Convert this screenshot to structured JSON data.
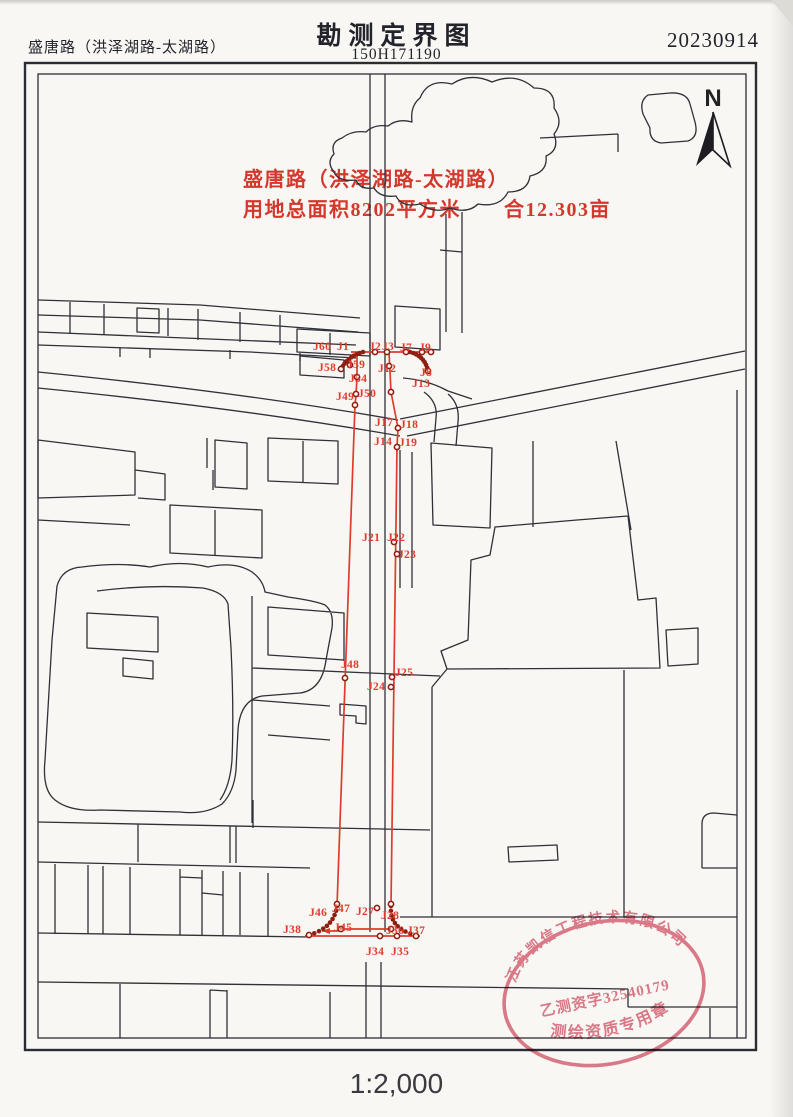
{
  "header": {
    "project": "盛唐路（洪泽湖路-太湖路）",
    "title": "勘测定界图",
    "sheet_no": "150H171190",
    "date": "20230914"
  },
  "annotation": {
    "line1": "盛唐路（洪泽湖路-太湖路）",
    "line2": "用地总面积8202平方米　　合12.303亩",
    "color": "#d4372b"
  },
  "north_label": "N",
  "scale_label": "1:2,000",
  "stamp": {
    "company": "江苏凯信工程技术有限公司",
    "license": "乙测资字32540179",
    "type_label": "测绘资质专用章",
    "color": "#d95f72"
  },
  "survey": {
    "line_color": "#e03c2d",
    "dot_color": "#8e1f12",
    "lines": [
      [
        [
          351,
          352
        ],
        [
          431,
          352
        ]
      ],
      [
        [
          357,
          352
        ],
        [
          357,
          377
        ],
        [
          356,
          395
        ],
        [
          355,
          405
        ],
        [
          337,
          906
        ]
      ],
      [
        [
          389,
          352
        ],
        [
          391,
          392
        ],
        [
          398,
          428
        ],
        [
          397,
          447
        ],
        [
          394,
          675
        ],
        [
          391,
          906
        ]
      ],
      [
        [
          305,
          936
        ],
        [
          420,
          936
        ]
      ],
      [
        [
          341,
          929
        ],
        [
          389,
          929
        ]
      ]
    ],
    "leader_arrow": {
      "from": [
        343,
        931
      ],
      "to": [
        322,
        931
      ]
    },
    "bead_arcs": [
      {
        "from": [
          363,
          352
        ],
        "ctrl": [
          348,
          356
        ],
        "to": [
          341,
          369
        ],
        "beads": 9
      },
      {
        "from": [
          410,
          352
        ],
        "ctrl": [
          425,
          356
        ],
        "to": [
          428,
          371
        ],
        "beads": 9
      },
      {
        "from": [
          337,
          906
        ],
        "ctrl": [
          334,
          928
        ],
        "to": [
          309,
          935
        ],
        "beads": 9
      },
      {
        "from": [
          391,
          906
        ],
        "ctrl": [
          389,
          929
        ],
        "to": [
          416,
          935
        ],
        "beads": 9
      }
    ],
    "vertex_dots": [
      [
        375,
        352
      ],
      [
        387,
        352
      ],
      [
        406,
        352
      ],
      [
        422,
        352
      ],
      [
        431,
        352
      ],
      [
        350,
        365
      ],
      [
        341,
        369
      ],
      [
        357,
        377
      ],
      [
        356,
        394
      ],
      [
        355,
        405
      ],
      [
        389,
        366
      ],
      [
        428,
        371
      ],
      [
        391,
        392
      ],
      [
        398,
        428
      ],
      [
        397,
        447
      ],
      [
        394,
        542
      ],
      [
        397,
        554
      ],
      [
        345,
        678
      ],
      [
        392,
        677
      ],
      [
        391,
        687
      ],
      [
        337,
        904
      ],
      [
        391,
        904
      ],
      [
        377,
        908
      ],
      [
        341,
        929
      ],
      [
        391,
        929
      ],
      [
        309,
        935
      ],
      [
        380,
        936
      ],
      [
        397,
        936
      ],
      [
        416,
        936
      ]
    ],
    "points": [
      {
        "label": "J60",
        "x": 313,
        "y": 350
      },
      {
        "label": "J1",
        "x": 337,
        "y": 350
      },
      {
        "label": "J2",
        "x": 369,
        "y": 350
      },
      {
        "label": "J3",
        "x": 382,
        "y": 350
      },
      {
        "label": "J7",
        "x": 400,
        "y": 351
      },
      {
        "label": "J9",
        "x": 419,
        "y": 351
      },
      {
        "label": "J58",
        "x": 318,
        "y": 371
      },
      {
        "label": "J59",
        "x": 347,
        "y": 368
      },
      {
        "label": "J12",
        "x": 378,
        "y": 372
      },
      {
        "label": "J8",
        "x": 420,
        "y": 376
      },
      {
        "label": "J54",
        "x": 349,
        "y": 382
      },
      {
        "label": "J13",
        "x": 412,
        "y": 387
      },
      {
        "label": "J49",
        "x": 336,
        "y": 400
      },
      {
        "label": "J50",
        "x": 358,
        "y": 397
      },
      {
        "label": "J17",
        "x": 375,
        "y": 426
      },
      {
        "label": "J18",
        "x": 400,
        "y": 428
      },
      {
        "label": "J14",
        "x": 374,
        "y": 445
      },
      {
        "label": "J19",
        "x": 399,
        "y": 446
      },
      {
        "label": "J21",
        "x": 362,
        "y": 541
      },
      {
        "label": "J22",
        "x": 387,
        "y": 541
      },
      {
        "label": "J23",
        "x": 398,
        "y": 558
      },
      {
        "label": "J48",
        "x": 341,
        "y": 668
      },
      {
        "label": "J25",
        "x": 395,
        "y": 676
      },
      {
        "label": "J24",
        "x": 367,
        "y": 690
      },
      {
        "label": "J46",
        "x": 309,
        "y": 916
      },
      {
        "label": "J47",
        "x": 332,
        "y": 912
      },
      {
        "label": "J27",
        "x": 356,
        "y": 915
      },
      {
        "label": "J28",
        "x": 381,
        "y": 919
      },
      {
        "label": "J38",
        "x": 283,
        "y": 933
      },
      {
        "label": "J45",
        "x": 334,
        "y": 931
      },
      {
        "label": "J36",
        "x": 386,
        "y": 934
      },
      {
        "label": "J37",
        "x": 407,
        "y": 934
      },
      {
        "label": "J34",
        "x": 366,
        "y": 955
      },
      {
        "label": "J35",
        "x": 391,
        "y": 955
      }
    ]
  }
}
